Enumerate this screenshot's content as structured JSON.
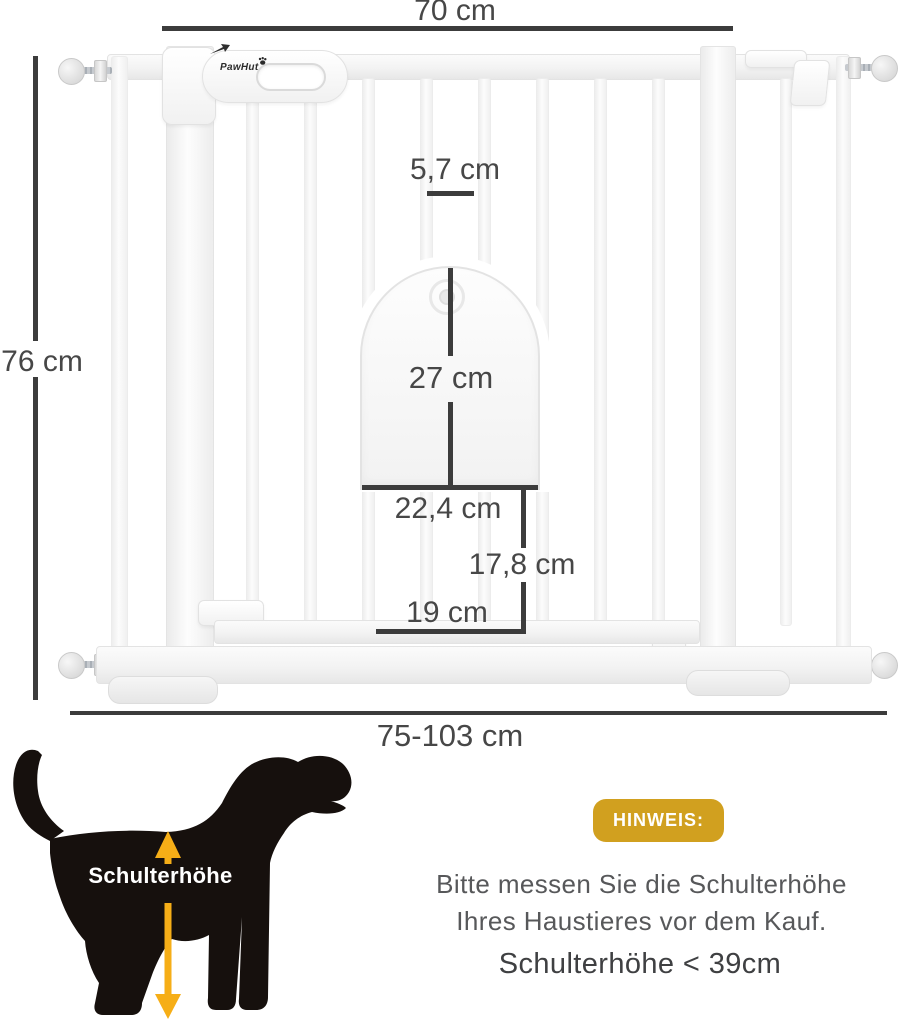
{
  "diagram": {
    "brand": "PawHut",
    "measurements": {
      "top_width": "70 cm",
      "bar_spacing": "5,7 cm",
      "gate_height": "76 cm",
      "pet_door_height": "27 cm",
      "pet_door_width": "22,4 cm",
      "lower_section_height": "17,8 cm",
      "lower_section_width": "19 cm",
      "adjustable_width": "75-103 cm"
    }
  },
  "dog_figure": {
    "label": "Schulterhöhe",
    "arrow_color": "#F6AE17",
    "silhouette_color": "#16100d"
  },
  "notice": {
    "badge": "HINWEIS:",
    "badge_color": "#D1A01F",
    "line1": "Bitte messen Sie die Schulterhöhe",
    "line2": "Ihres Haustieres vor dem Kauf.",
    "requirement": "Schulterhöhe < 39cm"
  },
  "icons": {
    "latch_arrow_icon": "small dark arrow on latch",
    "paw_icon": "paw print in brand logo",
    "pressure_screw_icon": "round pressure-fit spindle screw"
  },
  "colors": {
    "dimension_text": "#474747",
    "dimension_line": "#3c3c3c",
    "gate_white": "#ffffff"
  }
}
